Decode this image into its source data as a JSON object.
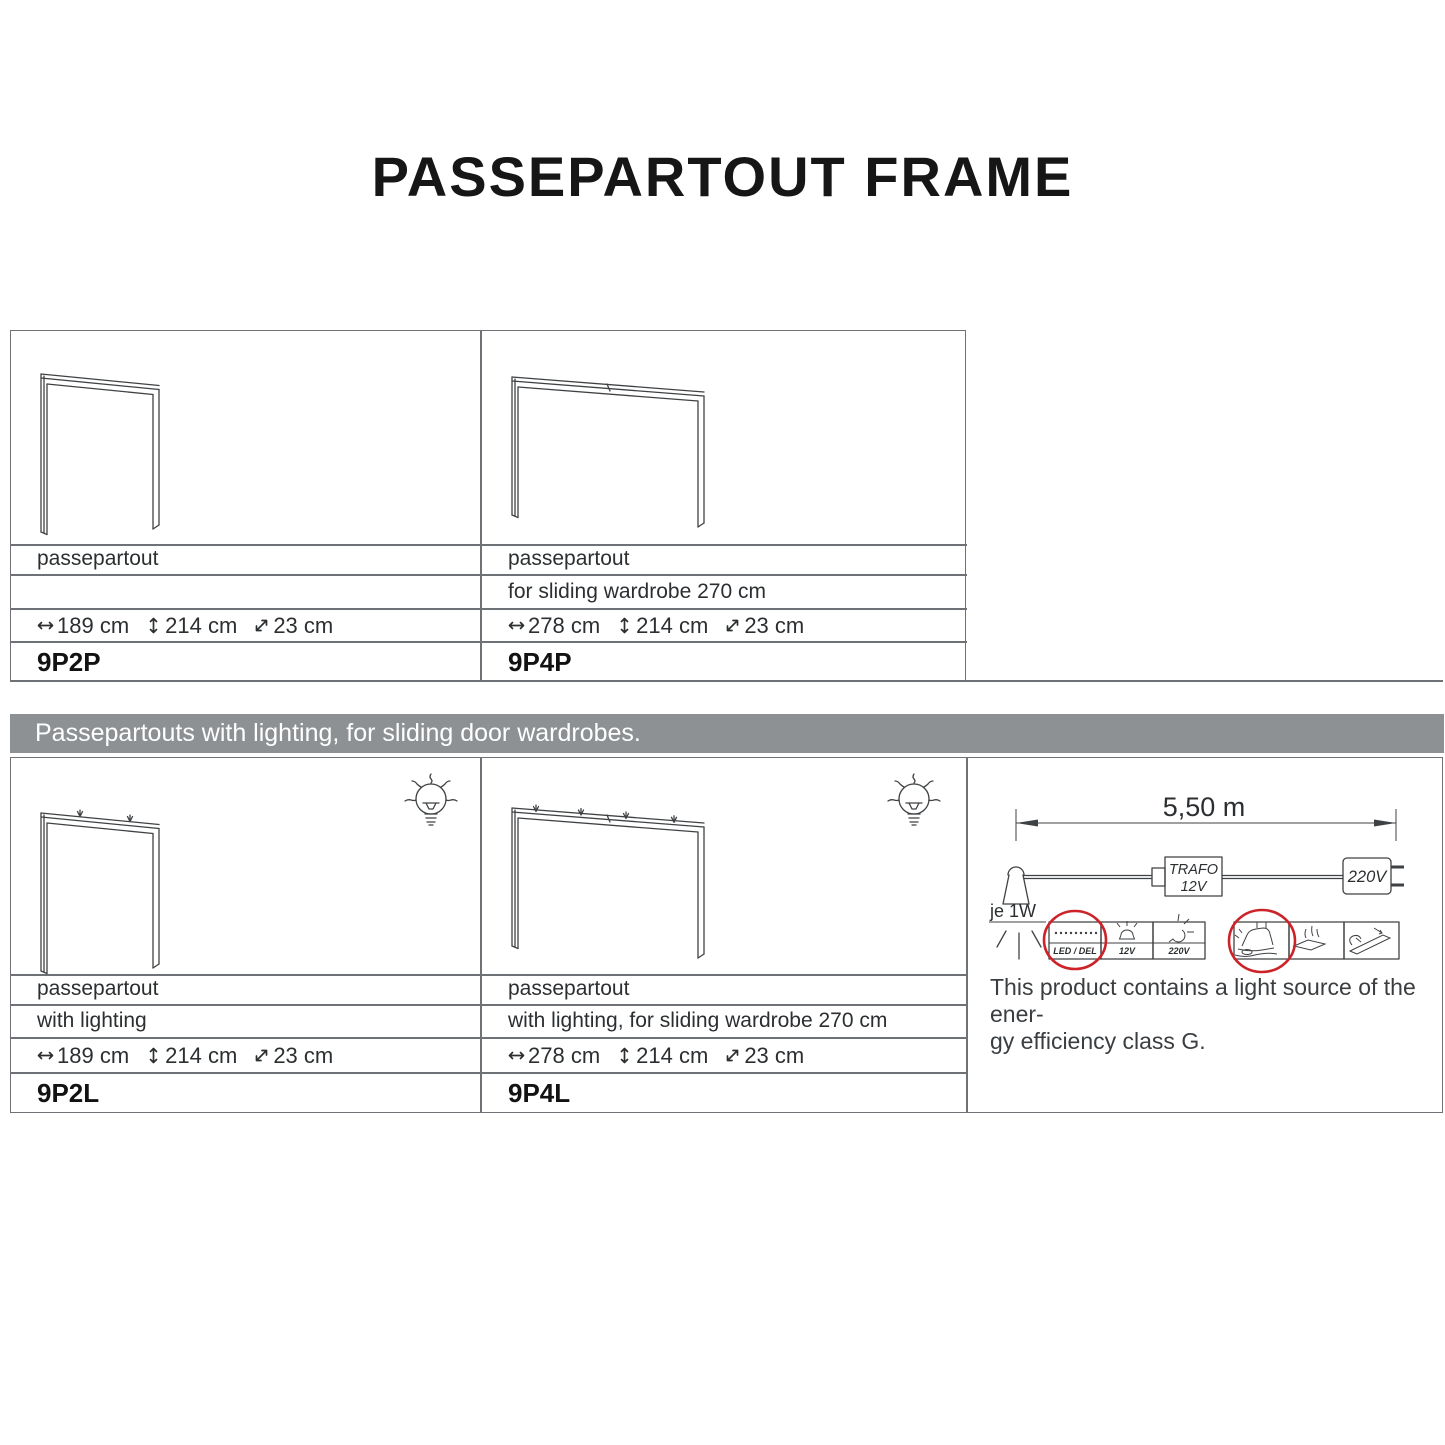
{
  "title": "PASSEPARTOUT FRAME",
  "banner": {
    "text": "Passepartouts with lighting, for sliding door wardrobes."
  },
  "products": [
    {
      "name": "passepartout",
      "description": "",
      "width": "189 cm",
      "height": "214 cm",
      "depth": "23 cm",
      "code": "9P2P"
    },
    {
      "name": "passepartout",
      "description": "for sliding wardrobe 270 cm",
      "width": "278 cm",
      "height": "214 cm",
      "depth": "23 cm",
      "code": "9P4P"
    },
    {
      "name": "passepartout",
      "description": "with lighting",
      "width": "189 cm",
      "height": "214 cm",
      "depth": "23 cm",
      "code": "9P2L"
    },
    {
      "name": "passepartout",
      "description": "with lighting, for sliding wardrobe 270 cm",
      "width": "278 cm",
      "height": "214 cm",
      "depth": "23 cm",
      "code": "9P4L"
    }
  ],
  "diagram": {
    "cable_length": "5,50 m",
    "transformer_label_line1": "TRAFO",
    "transformer_label_line2": "12V",
    "mains_label": "220V",
    "lamp_power": "je 1W",
    "icons": [
      {
        "name": "led-strip",
        "label": "LED / DEL",
        "highlighted": true
      },
      {
        "name": "bulb-12v",
        "label": "12V",
        "highlighted": false
      },
      {
        "name": "bulb-220v",
        "label": "220V",
        "highlighted": false
      },
      {
        "name": "foot-switch",
        "label": "",
        "highlighted": true
      },
      {
        "name": "touch-dimmer",
        "label": "",
        "highlighted": false
      },
      {
        "name": "led-batten",
        "label": "",
        "highlighted": false
      }
    ],
    "note_line1": "This product contains a light source of the ener-",
    "note_line2": "gy efficiency class G."
  },
  "colors": {
    "banner_bg": "#8d9194",
    "line_gray": "#6e7276",
    "drawing": "#3f4244",
    "text_dark": "#2c2f31",
    "highlight_red": "#cd2328",
    "title_black": "#161616"
  }
}
